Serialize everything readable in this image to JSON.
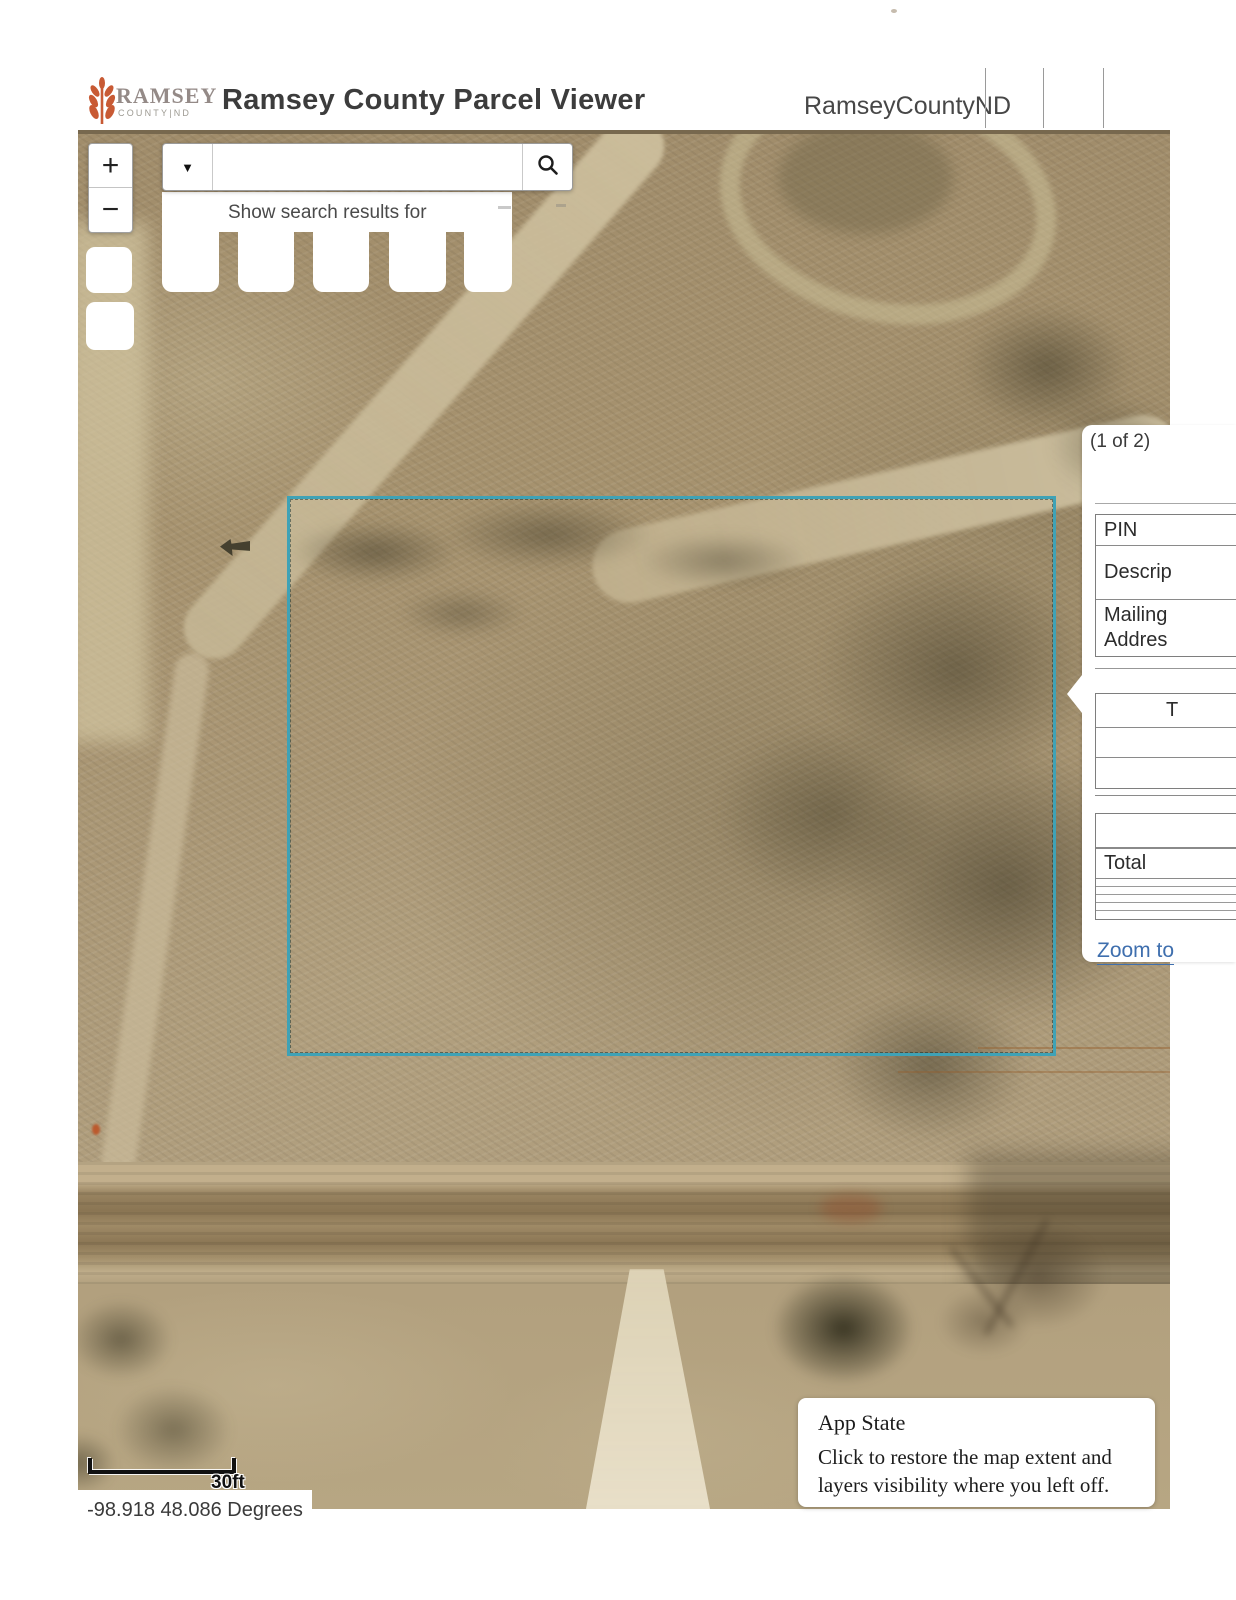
{
  "header": {
    "logo": {
      "line1": "RAMSEY",
      "line2": "COUNTY|ND",
      "brand_color": "#c85a34"
    },
    "title": "Ramsey County Parcel Viewer",
    "account_name": "RamseyCountyND"
  },
  "toolbar": {
    "zoom_in_label": "+",
    "zoom_out_label": "−"
  },
  "search": {
    "value": "",
    "dropdown_icon": "▼",
    "suggestion_text": "Show search results for"
  },
  "popup": {
    "pager": "(1 of 2)",
    "rows": {
      "pin": "PIN",
      "description": "Descrip",
      "mailing1": "Mailing",
      "mailing2": "Addres"
    },
    "tax_header": "T",
    "total_label": "Total",
    "zoom_to_label": "Zoom to",
    "link_color": "#3f6fae"
  },
  "map": {
    "parcel_outline_color": "#3fa2b6",
    "scalebar_label": "30ft",
    "coordinates": "-98.918 48.086 Degrees"
  },
  "toast": {
    "title": "App State",
    "message": "Click to restore the map extent and layers visibility where you left off."
  }
}
